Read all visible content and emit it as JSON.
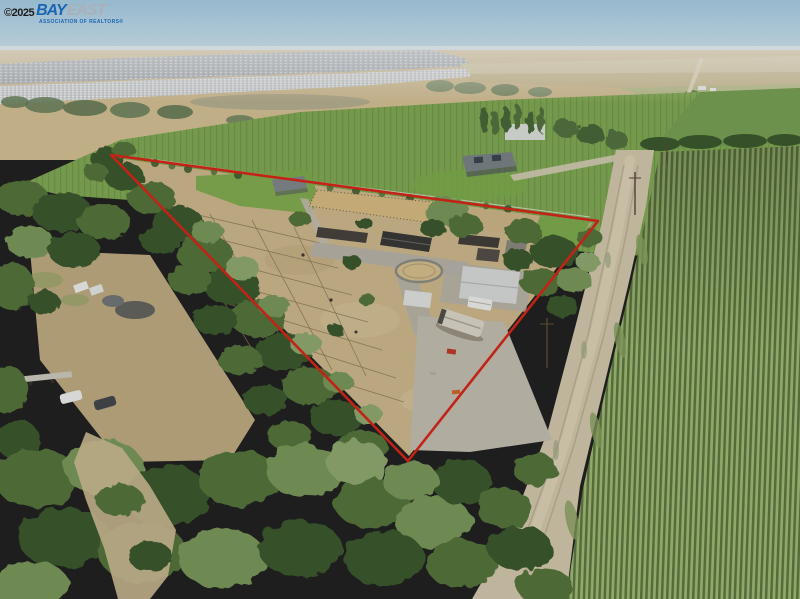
{
  "watermark": {
    "copyright": "©2025",
    "brand": {
      "bay": "BAY",
      "east": "EAST"
    },
    "tagline": "ASSOCIATION OF REALTORS®"
  },
  "scene": {
    "description": "Aerial drone photo of a triangular horse-ranch parcel outlined in red: paddocks, barns, round pen and RV inside; oak trees along the left and bottom, a corn field and dirt road on the right, green farmland, a neighboring home, and a distant suburb on the hazy horizon."
  },
  "boundary": {
    "points": "111,155 598,221 408,461"
  },
  "colors": {
    "boundary-red": "#d8281a",
    "brand-blue": "#1966b3",
    "brand-gray": "#a8b1ba",
    "copyright-ink": "#1c1c1c",
    "sky-top": "#a9cfe6",
    "sky-bottom": "#d9ebf4",
    "suburb": "#b4bac0",
    "suburb-light": "#d7dadb",
    "dist-field": "#d7c398",
    "dist-field-light": "#e3d2ab",
    "strip-tan": "#dccfa9",
    "strip-tan2": "#cfc096",
    "strip-green": "#bcc490",
    "green-field": "#83ac55",
    "green-field-dark": "#78a355",
    "lawn": "#7fae4f",
    "corn-light": "#a4bc78",
    "corn-dark": "#5e7940",
    "road": "#d6cbaf",
    "road-light": "#e4dabf",
    "track": "#b7ab8d",
    "dirt": "#d0ba8e",
    "dirt-dark": "#c2ab7e",
    "dirt-light": "#dcc9a0",
    "gravel": "#c6c1b3",
    "concrete": "#b8b6ae",
    "arena": "#d9bd84",
    "tree-dark": "#3d5a2f",
    "tree-mid": "#55763c",
    "tree-light": "#7b9b5c",
    "tree-pale": "#93ac72",
    "roof-dark": "#3a3a38",
    "roof-brown": "#4a4440",
    "roof-gray": "#8d8a82",
    "roof-white": "#dcdedd",
    "house-roof": "#82898c",
    "white": "#f1f2ef",
    "accent-red": "#c23b2a",
    "accent-orange": "#cd6b2e",
    "pole": "#5a4a36"
  }
}
